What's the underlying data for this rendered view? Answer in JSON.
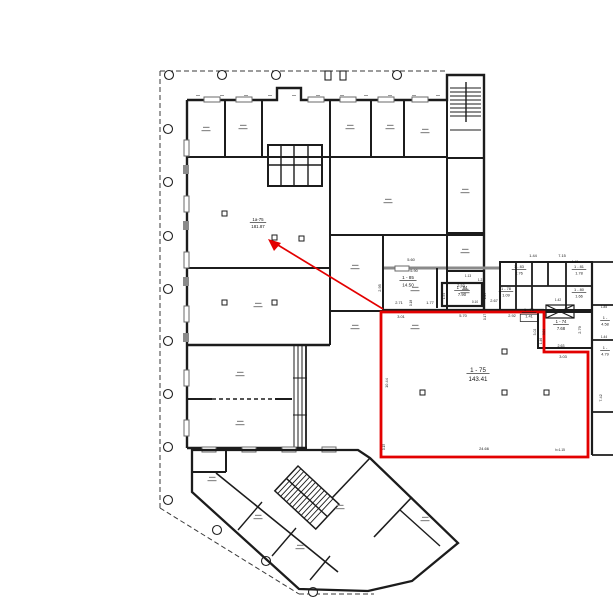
{
  "drawing": {
    "kind": "architectural floor plan",
    "colors": {
      "highlight": "#e30000",
      "walls": "#1c1c1c",
      "muted_walls": "#8a8a8a",
      "boundary": "#3a3a3a"
    }
  },
  "highlighted_room": {
    "number": "1 - 75",
    "area": "143.41"
  },
  "arrow_target_room": {
    "number": "1a-75",
    "area": "181.87"
  },
  "room_labels": [
    {
      "number": "1a-75",
      "area": "181.87",
      "x": 258,
      "y": 221,
      "fs": 4.4
    },
    {
      "number": "1 - 85",
      "area": "14.50",
      "x": 408,
      "y": 279,
      "fs": 4.6
    },
    {
      "number": "1 - 84",
      "area": "7.90",
      "x": 462,
      "y": 289,
      "fs": 4.2
    },
    {
      "number": "1 - 83",
      "area": "2.76",
      "x": 519,
      "y": 268,
      "fs": 3.9
    },
    {
      "number": "1 - 81",
      "area": "1.78",
      "x": 579,
      "y": 268,
      "fs": 3.9
    },
    {
      "number": "1 - 78",
      "area": "1.09",
      "x": 506,
      "y": 290,
      "fs": 3.9
    },
    {
      "number": "1 - 80",
      "area": "1.66",
      "x": 579,
      "y": 291,
      "fs": 3.9
    },
    {
      "number": "1 - 79",
      "area": "1.41",
      "x": 529,
      "y": 311,
      "fs": 3.9,
      "boxed": true
    },
    {
      "number": "1 - 74",
      "area": "7.68",
      "x": 561,
      "y": 323,
      "fs": 4.2
    },
    {
      "number": "1 -",
      "area": "4.58",
      "x": 605,
      "y": 319,
      "fs": 3.9
    },
    {
      "number": "1 -",
      "area": "4.79",
      "x": 605,
      "y": 349,
      "fs": 3.9
    },
    {
      "number": "1 - 75",
      "area": "143.41",
      "x": 478,
      "y": 372,
      "fs": 6.2
    }
  ],
  "dimension_labels": [
    {
      "t": "5.60",
      "x": 411,
      "y": 261
    },
    {
      "t": "5.90",
      "x": 414,
      "y": 272
    },
    {
      "t": "2.95",
      "x": 381,
      "y": 288,
      "r": -90
    },
    {
      "t": "2.71",
      "x": 399,
      "y": 304
    },
    {
      "t": "0.18",
      "x": 412,
      "y": 303,
      "r": -90,
      "fs": 3.2
    },
    {
      "t": "1.77",
      "x": 430,
      "y": 304
    },
    {
      "t": "2.53",
      "x": 461,
      "y": 287
    },
    {
      "t": "1.13",
      "x": 468,
      "y": 277,
      "fs": 3.2
    },
    {
      "t": "1.21",
      "x": 481,
      "y": 281,
      "fs": 3.2
    },
    {
      "t": "1.54",
      "x": 445,
      "y": 296,
      "r": -90,
      "fs": 3.2
    },
    {
      "t": "1.64",
      "x": 486,
      "y": 296,
      "r": -90,
      "fs": 3.2
    },
    {
      "t": "0.10",
      "x": 475,
      "y": 303,
      "fs": 3.2
    },
    {
      "t": "2.67",
      "x": 494,
      "y": 302
    },
    {
      "t": "1.44",
      "x": 533,
      "y": 257
    },
    {
      "t": "7.15",
      "x": 562,
      "y": 257
    },
    {
      "t": "1.42",
      "x": 575,
      "y": 263,
      "fs": 3.2
    },
    {
      "t": "1.42",
      "x": 558,
      "y": 301,
      "fs": 3.2
    },
    {
      "t": "3.01",
      "x": 401,
      "y": 318
    },
    {
      "t": "5.70",
      "x": 463,
      "y": 317
    },
    {
      "t": "0.17",
      "x": 486,
      "y": 317,
      "r": -90,
      "fs": 3.2
    },
    {
      "t": "2.92",
      "x": 512,
      "y": 317
    },
    {
      "t": "3.02",
      "x": 536,
      "y": 332,
      "r": -90,
      "fs": 3.4
    },
    {
      "t": "3.04",
      "x": 545,
      "y": 332,
      "r": -90,
      "fs": 3.2
    },
    {
      "t": "2.79",
      "x": 581,
      "y": 330,
      "r": -90
    },
    {
      "t": "1.46",
      "x": 542,
      "y": 341,
      "r": -90,
      "fs": 3.2
    },
    {
      "t": "2.63",
      "x": 561,
      "y": 347,
      "fs": 3.6
    },
    {
      "t": "3.03",
      "x": 563,
      "y": 358
    },
    {
      "t": "10.44",
      "x": 388,
      "y": 383,
      "r": -90
    },
    {
      "t": "24.66",
      "x": 484,
      "y": 450
    },
    {
      "t": "h=1.15",
      "x": 560,
      "y": 451,
      "fs": 3.2
    },
    {
      "t": "0.15",
      "x": 385,
      "y": 447,
      "r": -90,
      "fs": 3.2
    },
    {
      "t": "7.42",
      "x": 602,
      "y": 398,
      "r": -90
    },
    {
      "t": "1.85",
      "x": 604,
      "y": 308,
      "fs": 3.2
    },
    {
      "t": "1.44",
      "x": 604,
      "y": 338,
      "fs": 3.2
    }
  ]
}
